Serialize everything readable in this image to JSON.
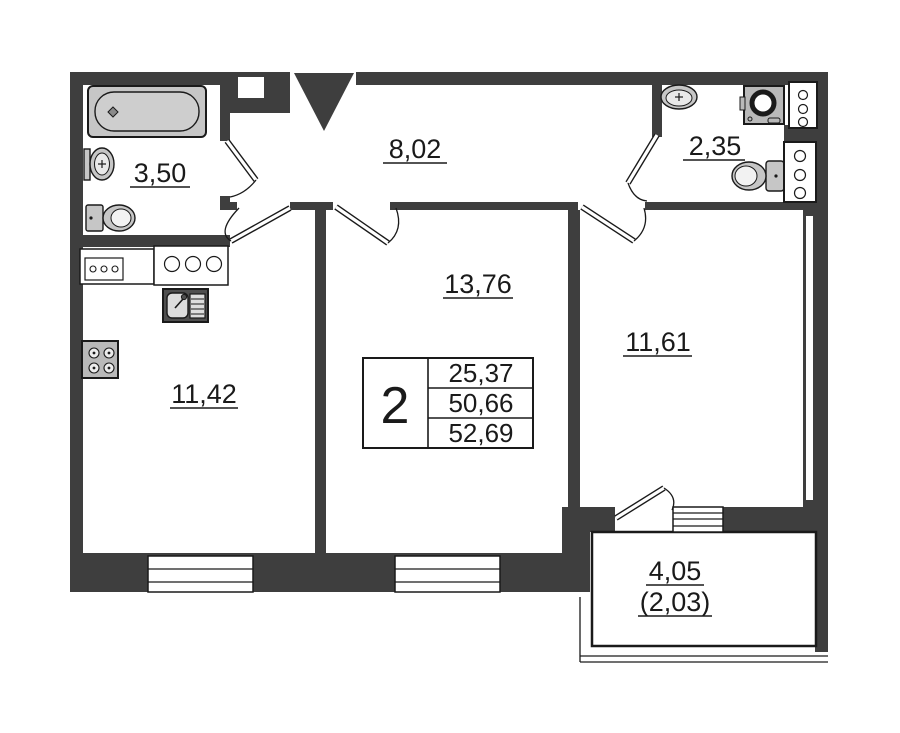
{
  "title": "apartment-floor-plan",
  "areas": {
    "bathroom": "3,50",
    "hallway": "8,02",
    "wc": "2,35",
    "living": "13,76",
    "kitchen": "11,42",
    "bedroom": "11,61",
    "balcony": "4,05",
    "balcony_reduced": "(2,03)"
  },
  "table": {
    "rooms_count": "2",
    "values": [
      "25,37",
      "50,66",
      "52,69"
    ]
  },
  "colors": {
    "wall": "#3e3e3e",
    "fixture": "#c6c6c6",
    "line": "#1a1a1a",
    "background": "#ffffff"
  },
  "fixtures": [
    "bathtub",
    "bath-sink",
    "bath-toilet",
    "kitchen-counter",
    "cooktop-counter",
    "kitchen-sink",
    "stove",
    "wc-sink",
    "washing-machine",
    "wc-toilet",
    "vent-shaft",
    "vent-shaft",
    "window",
    "window",
    "balcony-window",
    "entrance-door"
  ]
}
